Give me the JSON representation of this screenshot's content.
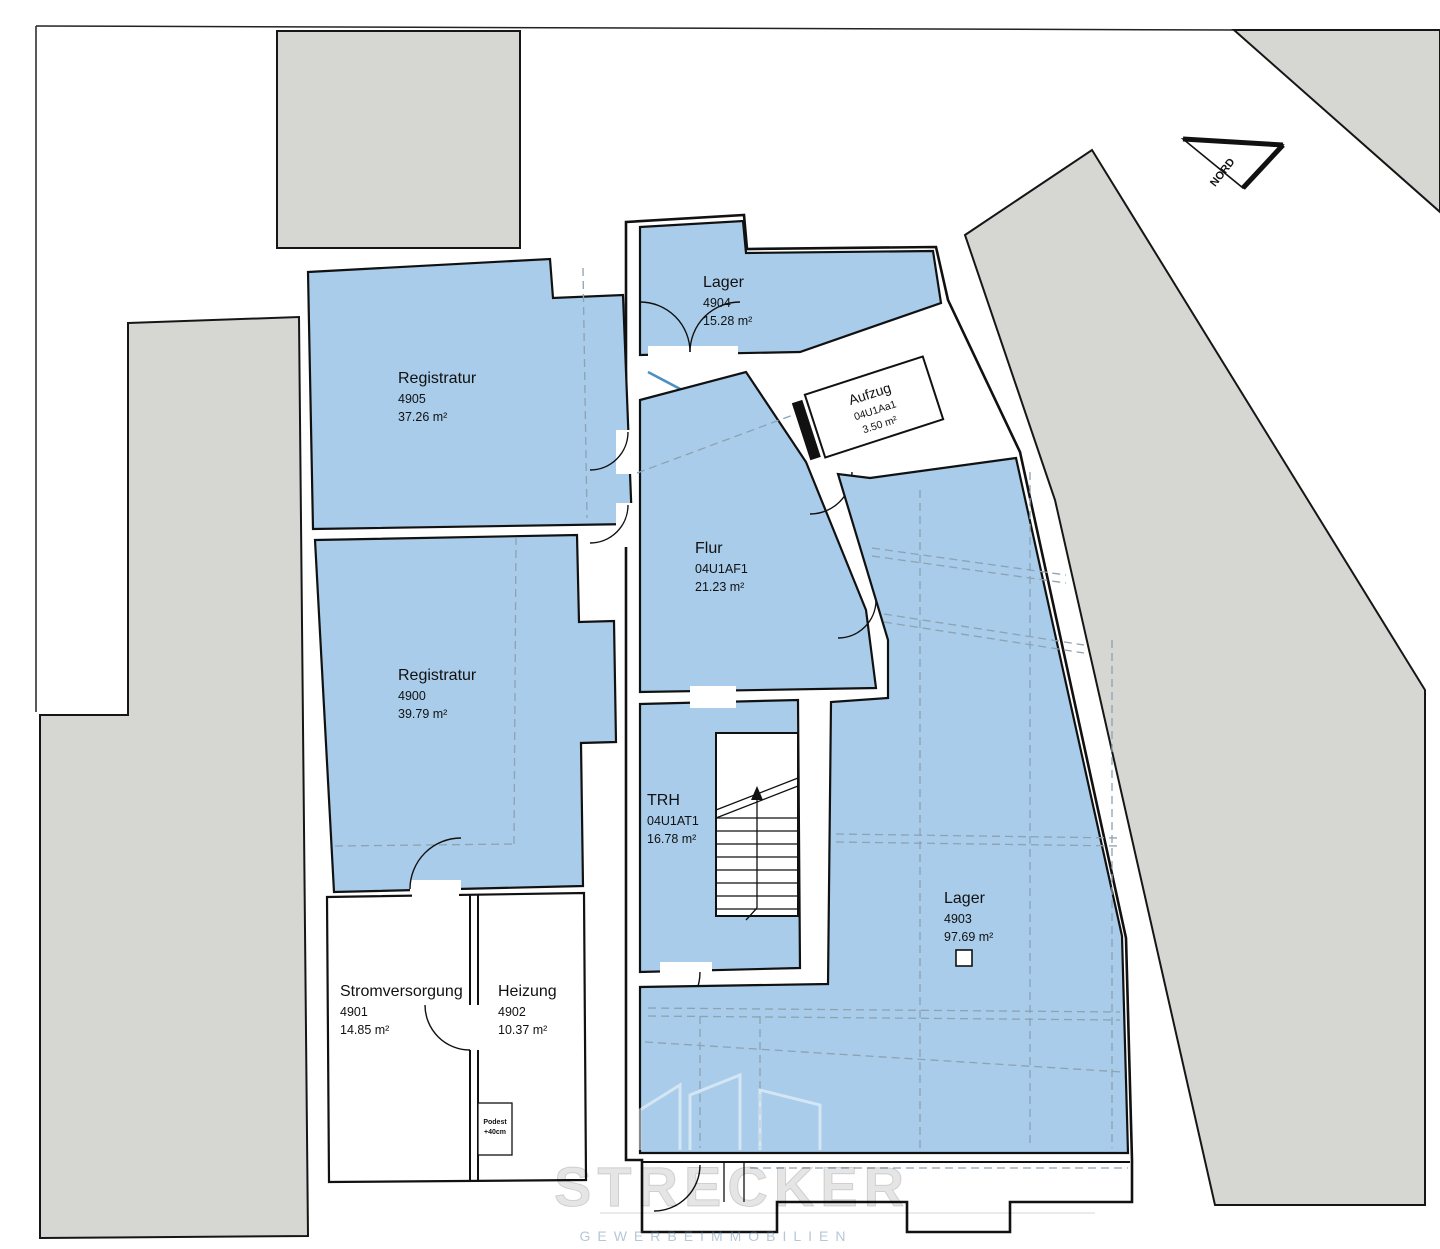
{
  "document": {
    "kind": "basement floor plan"
  },
  "colors": {
    "room_fill": "#a8cce9",
    "neighbor_fill": "#d6d7d2",
    "wall": "#111111",
    "door_leaf": "#4a90c4"
  },
  "north_arrow": {
    "label": "NORD"
  },
  "rooms": [
    {
      "name": "Registratur",
      "code": "4905",
      "area": "37.26 m²"
    },
    {
      "name": "Lager",
      "code": "4904",
      "area": "15.28 m²"
    },
    {
      "name": "Aufzug",
      "code": "04U1Aa1",
      "area": "3.50 m²"
    },
    {
      "name": "Flur",
      "code": "04U1AF1",
      "area": "21.23 m²"
    },
    {
      "name": "Registratur",
      "code": "4900",
      "area": "39.79 m²"
    },
    {
      "name": "TRH",
      "code": "04U1AT1",
      "area": "16.78 m²"
    },
    {
      "name": "Lager",
      "code": "4903",
      "area": "97.69 m²"
    },
    {
      "name": "Stromversorgung",
      "code": "4901",
      "area": "14.85 m²"
    },
    {
      "name": "Heizung",
      "code": "4902",
      "area": "10.37 m²"
    }
  ],
  "annotations": {
    "podest_line1": "Podest",
    "podest_line2": "+40cm"
  },
  "watermark": {
    "brand": "STRECKER",
    "tagline": "GEWERBEIMMOBILIEN"
  }
}
